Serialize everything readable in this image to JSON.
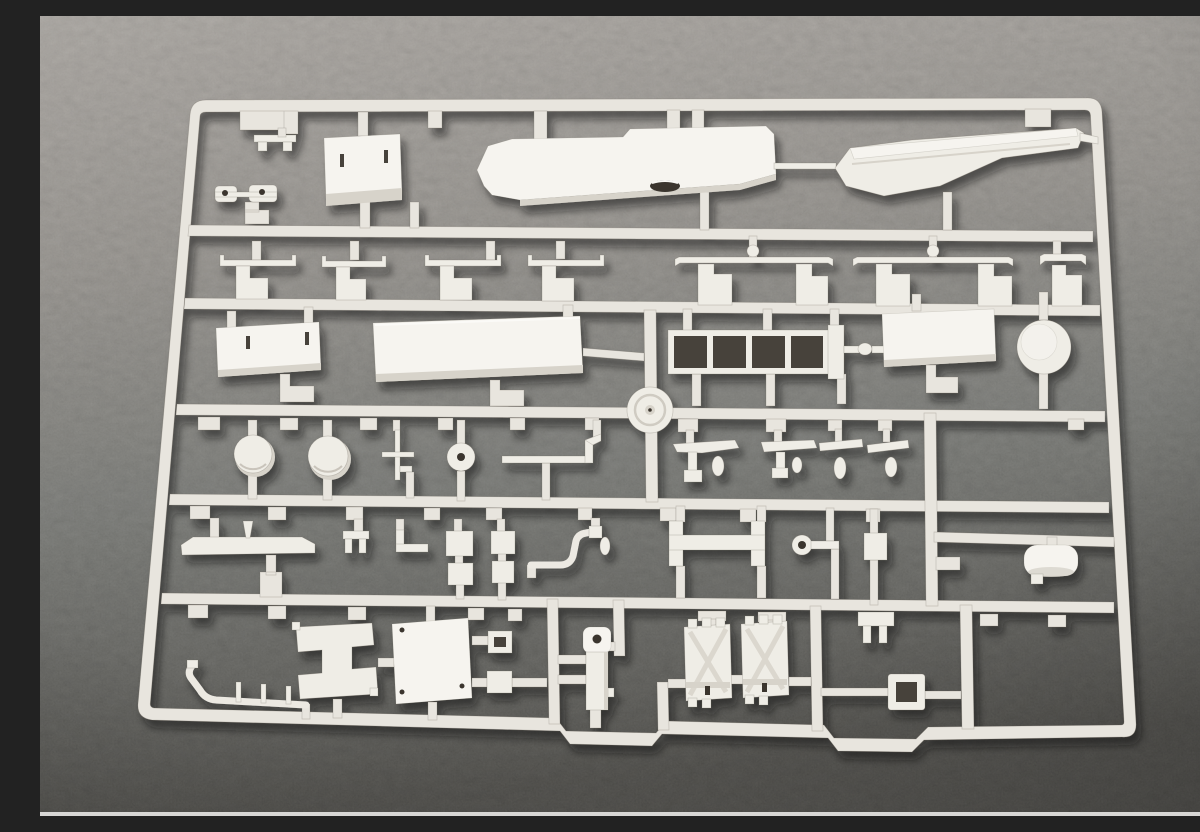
{
  "meta": {
    "domain": "Natural-Image",
    "description": "Close-up photograph of an unpainted off-white injection-molded plastic model kit sprue (parts tree) lying on a dark gray felt-like fabric surface",
    "alt": "Plastic model kit sprue with many small unassembled parts on gray fabric"
  },
  "palette": {
    "fabric_top": "#a5a19c",
    "fabric_mid": "#85827d",
    "fabric_bottom": "#4c4b47",
    "plastic": "#ece9e2",
    "plastic_bright": "#f6f4ef",
    "plastic_shadow": "#d7d3ca",
    "recess_dark": "#46423b",
    "photo_edge_strip": "#d8d7d5"
  },
  "sprue": {
    "material": "light gray styrene plastic",
    "rows": 6,
    "part_groups": [
      {
        "row": 1,
        "name": "small corner bracket"
      },
      {
        "row": 1,
        "name": "twin clip strip"
      },
      {
        "row": 1,
        "name": "rectangular deckhouse box"
      },
      {
        "row": 1,
        "name": "ship hull half (bow left)"
      },
      {
        "row": 1,
        "name": "ship hull half (stern right)"
      },
      {
        "row": 2,
        "name": "seven davit-style rail brackets"
      },
      {
        "row": 3,
        "name": "slotted flat panel"
      },
      {
        "row": 3,
        "name": "large deck slab"
      },
      {
        "row": 3,
        "name": "open ladder / track frame with four cells"
      },
      {
        "row": 3,
        "name": "center turntable wheel on rail junction"
      },
      {
        "row": 3,
        "name": "plain flat panel"
      },
      {
        "row": 3,
        "name": "round disc"
      },
      {
        "row": 4,
        "name": "two domed turret discs"
      },
      {
        "row": 4,
        "name": "thin cross mast"
      },
      {
        "row": 4,
        "name": "small pulley disc with hole"
      },
      {
        "row": 4,
        "name": "stepped rod"
      },
      {
        "row": 4,
        "name": "two mallet-shaped davits with teardrop blobs"
      },
      {
        "row": 4,
        "name": "two winged propeller blanks"
      },
      {
        "row": 5,
        "name": "long boat beam"
      },
      {
        "row": 5,
        "name": "fork piece"
      },
      {
        "row": 5,
        "name": "tee foot piece"
      },
      {
        "row": 5,
        "name": "two stacked square pads x2"
      },
      {
        "row": 5,
        "name": "bent lamp rod"
      },
      {
        "row": 5,
        "name": "bar with end flanges"
      },
      {
        "row": 5,
        "name": "eyelet key rod"
      },
      {
        "row": 5,
        "name": "small block"
      },
      {
        "row": 5,
        "name": "horizontal cylinder drum (right cell)"
      },
      {
        "row": 6,
        "name": "bent pipe with pins"
      },
      {
        "row": 6,
        "name": "H-shaped panel"
      },
      {
        "row": 6,
        "name": "square hatch panel with rivets"
      },
      {
        "row": 6,
        "name": "two small pads"
      },
      {
        "row": 6,
        "name": "vertical cylinder with bored top"
      },
      {
        "row": 6,
        "name": "two X-ribbed track pads"
      },
      {
        "row": 6,
        "name": "two-prong fork"
      },
      {
        "row": 6,
        "name": "open buckle frame"
      }
    ]
  }
}
